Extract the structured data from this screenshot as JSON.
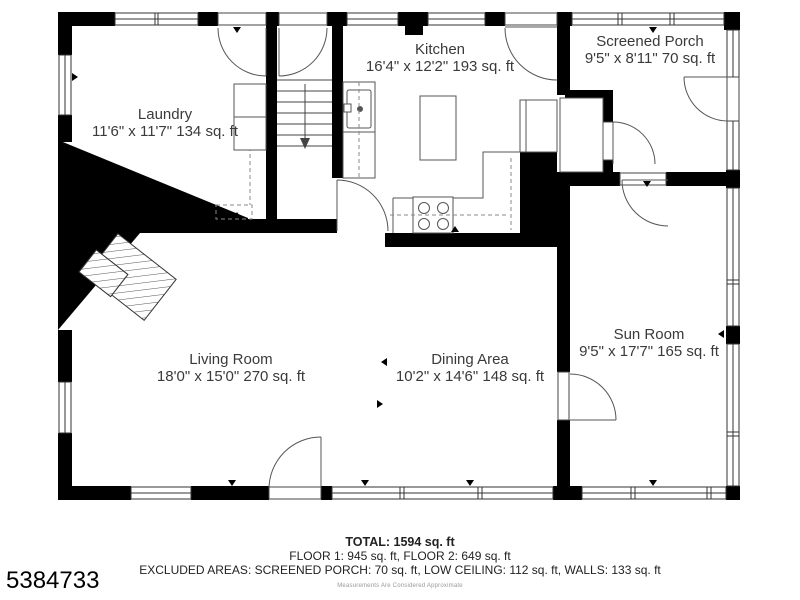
{
  "plan": {
    "title": "First floor plan",
    "rooms": [
      {
        "id": "laundry",
        "name": "Laundry",
        "dims": "11'6\" x 11'7\" 134 sq. ft"
      },
      {
        "id": "kitchen",
        "name": "Kitchen",
        "dims": "16'4\" x 12'2\" 193 sq. ft"
      },
      {
        "id": "screened-porch",
        "name": "Screened Porch",
        "dims": "9'5\" x 8'11\" 70 sq. ft"
      },
      {
        "id": "living-room",
        "name": "Living Room",
        "dims": "18'0\" x 15'0\" 270 sq. ft"
      },
      {
        "id": "dining-area",
        "name": "Dining Area",
        "dims": "10'2\" x 14'6\" 148 sq. ft"
      },
      {
        "id": "sun-room",
        "name": "Sun Room",
        "dims": "9'5\" x 17'7\" 165 sq. ft"
      }
    ],
    "summary": {
      "total": "TOTAL: 1594 sq. ft",
      "floors": "FLOOR 1: 945 sq. ft, FLOOR 2: 649 sq. ft",
      "excluded": "EXCLUDED AREAS: SCREENED PORCH: 70 sq. ft, LOW CEILING: 112 sq. ft, WALLS: 133 sq. ft",
      "disclaimer": "Measurements Are Considered Approximate"
    },
    "mls_number": "5384733",
    "colors": {
      "wall": "#000000",
      "line": "#4a4a4a",
      "text": "#3a3a3a",
      "background": "#ffffff"
    },
    "icons": [
      "stairs-icon",
      "fireplace-icon",
      "sink-icon",
      "stove-icon",
      "kitchen-island",
      "washer-dryer-icon",
      "door-swing-icon",
      "window-icon"
    ]
  }
}
